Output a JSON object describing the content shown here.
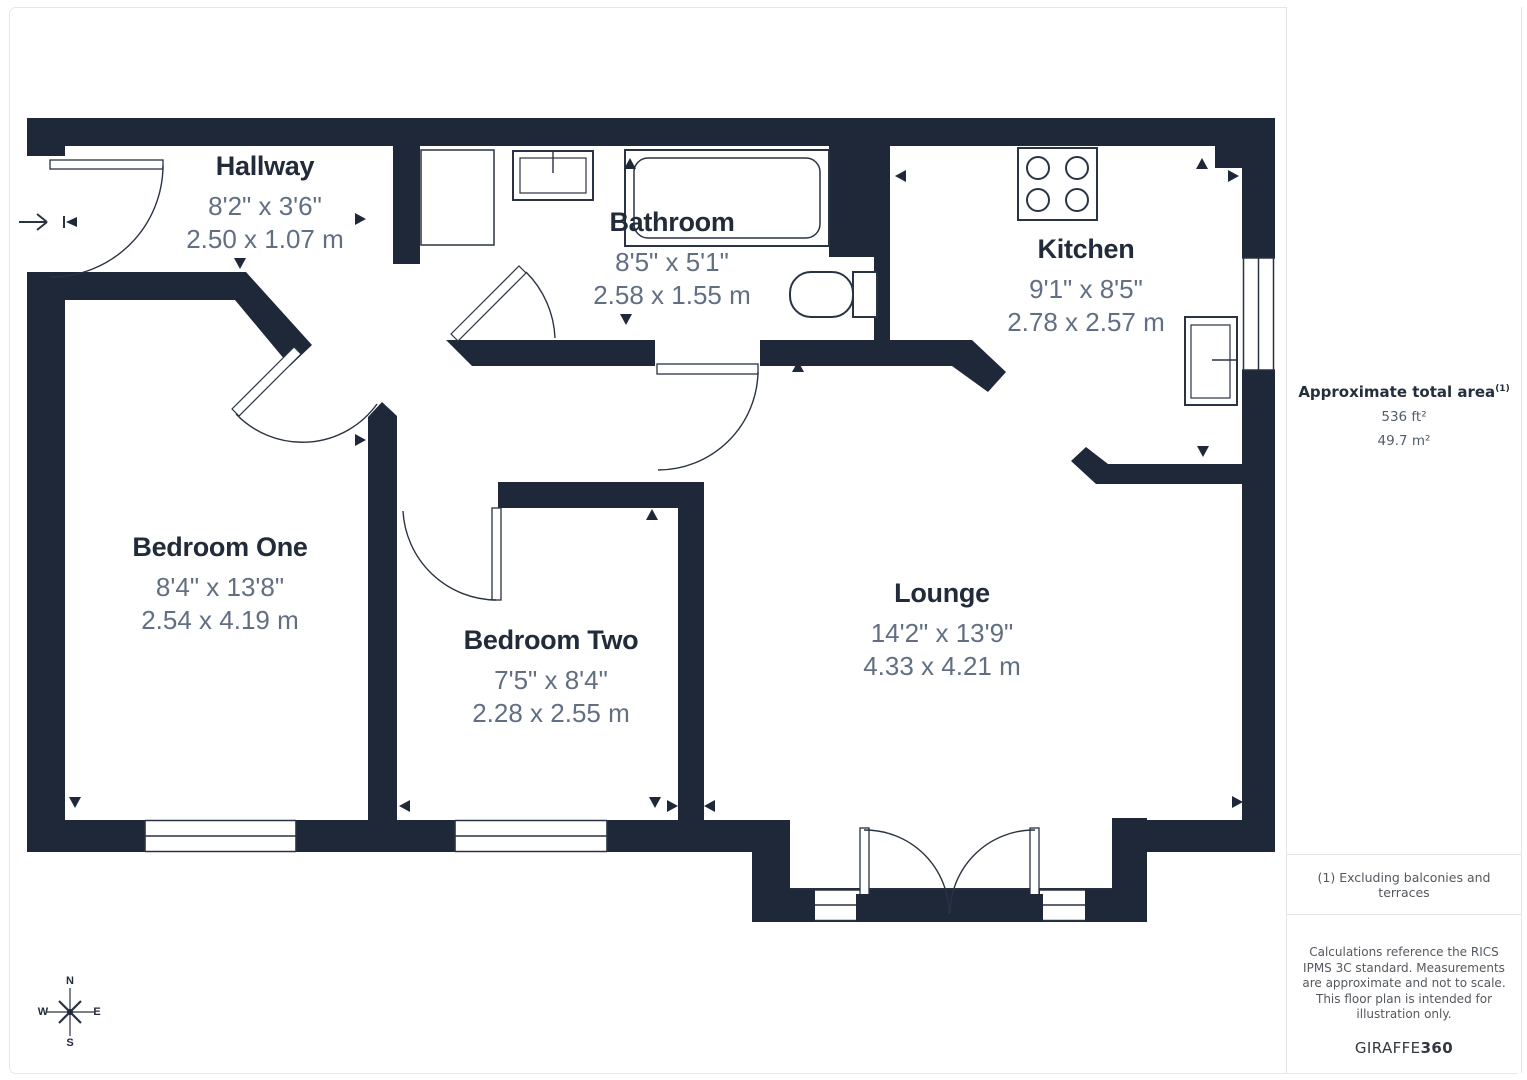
{
  "plan": {
    "rooms": [
      {
        "name": "Hallway",
        "imperial": "8'2\" x 3'6\"",
        "metric": "2.50 x 1.07 m"
      },
      {
        "name": "Bathroom",
        "imperial": "8'5\" x 5'1\"",
        "metric": "2.58 x 1.55 m"
      },
      {
        "name": "Kitchen",
        "imperial": "9'1\" x 8'5\"",
        "metric": "2.78 x 2.57 m"
      },
      {
        "name": "Bedroom One",
        "imperial": "8'4\" x 13'8\"",
        "metric": "2.54 x 4.19 m"
      },
      {
        "name": "Bedroom Two",
        "imperial": "7'5\" x 8'4\"",
        "metric": "2.28 x 2.55 m"
      },
      {
        "name": "Lounge",
        "imperial": "14'2\" x 13'9\"",
        "metric": "4.33 x 4.21 m"
      }
    ],
    "compass": {
      "n": "N",
      "s": "S",
      "e": "E",
      "w": "W"
    }
  },
  "sidebar": {
    "area_title": "Approximate total area",
    "area_footnote_marker": "(1)",
    "area_ft": "536 ft²",
    "area_m": "49.7 m²",
    "footnote": "(1) Excluding balconies and terraces",
    "disclaimer": "Calculations reference the RICS IPMS 3C standard. Measurements are approximate and not to scale. This floor plan is intended for illustration only.",
    "brand_regular": "GIRAFFE",
    "brand_bold": "360"
  },
  "colors": {
    "wall": "#1f2839",
    "room_name": "#222b3a",
    "dimensions_text": "#626f83",
    "divider": "#e2e4e7",
    "muted_text": "#54585e"
  }
}
